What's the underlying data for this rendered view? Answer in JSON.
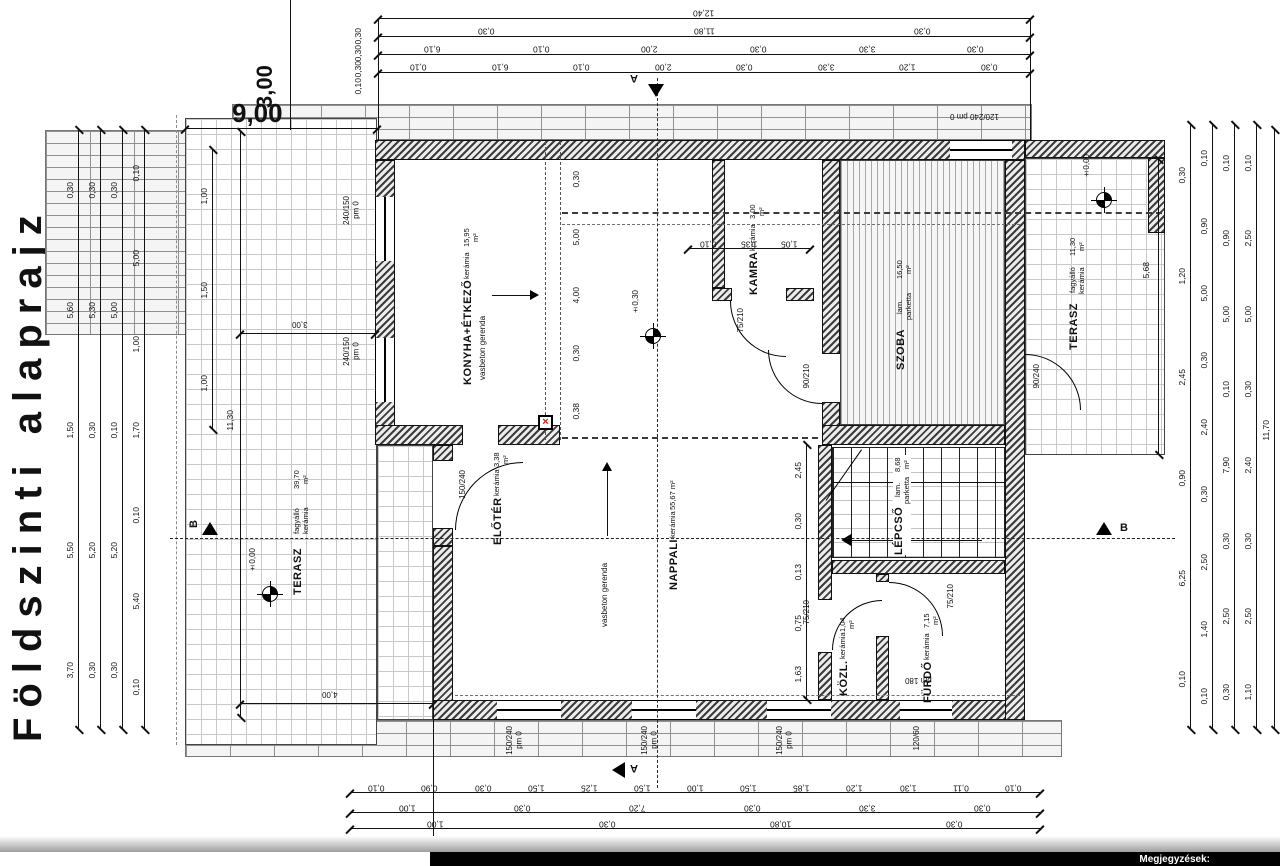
{
  "title": "Földszinti alaprajz",
  "footer": {
    "note_label": "Megjegyzések:"
  },
  "markers": {
    "section_a": "A",
    "section_b": "B",
    "level_terrace": "±0,00",
    "level_interior": "±0,30",
    "level_terrace_right": "±0,00",
    "column_x": "×"
  },
  "beam_label": "vasbeton gerenda",
  "big_dims": {
    "top_width": "9,00",
    "top_offset": "3,00",
    "terrace_width": "3,00",
    "terrace_length": "11,30",
    "terrace_bottom": "4,00",
    "right_terrace_depth": "5,68"
  },
  "rooms": {
    "konyha": {
      "name": "KONYHA+ÉTKEZŐ",
      "floor": "kerámia",
      "area": "15,95 m²"
    },
    "kamra": {
      "name": "KAMRA",
      "floor": "kerámia",
      "area": "3,00 m²"
    },
    "szoba": {
      "name": "SZOBA",
      "floor": "lam. parketta",
      "area": "16,50 m²"
    },
    "nappali": {
      "name": "NAPPALI",
      "floor": "kerámia",
      "area": "55,67 m²"
    },
    "eloter": {
      "name": "ELŐTÉR",
      "floor": "kerámia",
      "area": "3,38 m²"
    },
    "lepcso": {
      "name": "LÉPCSŐ",
      "floor": "lam. parketta",
      "area": "8,68 m²"
    },
    "kozlekedo": {
      "name": "KÖZL.",
      "floor": "kerámia",
      "area": "1,04 m²"
    },
    "furdo": {
      "name": "FÜRDŐ",
      "floor": "kerámia",
      "area": "7,15 m²"
    },
    "terasz_bal": {
      "name": "TERASZ",
      "floor": "fagyálló kerámia",
      "area": "39,70 m²"
    },
    "terasz_jobb": {
      "name": "TERASZ",
      "floor": "fagyálló kerámia",
      "area": "11,30 m²"
    }
  },
  "windows": {
    "konyha_1": {
      "size": "240/150",
      "pm": "pm 0"
    },
    "konyha_2": {
      "size": "240/150",
      "pm": "pm 0"
    },
    "bottom_1": {
      "size": "150/240",
      "pm": "pm 0"
    },
    "bottom_2": {
      "size": "150/240",
      "pm": "pm 0"
    },
    "bottom_3": {
      "size": "150/240",
      "pm": "pm 0"
    },
    "furdo_w": {
      "size": "120/60",
      "pm": "pm 180"
    },
    "top_w": {
      "size": "120/240",
      "pm": "pm 0"
    }
  },
  "doors": {
    "bejarat": {
      "size": "150/240"
    },
    "kamra_d": {
      "size": "75/210"
    },
    "szoba_bal": {
      "size": "90/210"
    },
    "szoba_terasz": {
      "size": "90/240"
    },
    "kozl_d": {
      "size": "75/210"
    },
    "furdo_d": {
      "size": "75/210"
    }
  },
  "chains": {
    "top_1": [
      "12,40"
    ],
    "top_2": [
      "0,30",
      "11,80",
      "0,30"
    ],
    "top_3": [
      "6,10",
      "0,10",
      "2,00",
      "0,30",
      "3,30",
      "0,30"
    ],
    "top_4": [
      "0,10",
      "6,10",
      "0,10",
      "2,00",
      "0,30",
      "3,30",
      "1,20",
      "0,30"
    ],
    "top_corner": [
      "0,30",
      "0,30",
      "0,30",
      "0,10"
    ],
    "bottom_1": [
      "0,10",
      "0,90",
      "0,30",
      "1,50",
      "1,25",
      "1,50",
      "1,00",
      "1,50",
      "1,85",
      "1,20",
      "1,30",
      "0,11",
      "0,10"
    ],
    "bottom_2": [
      "1,00",
      "0,30",
      "7,20",
      "0,30",
      "3,30",
      "0,30"
    ],
    "bottom_3": [
      "1,00",
      "0,30",
      "10,80",
      "0,30"
    ],
    "bottom_4": [
      "1,00",
      "11,40"
    ],
    "left_1": [
      "0,30",
      "5,60",
      "1,50",
      "5,50",
      "3,70"
    ],
    "left_2": [
      "0,30",
      "5,30",
      "0,30",
      "5,20",
      "0,30"
    ],
    "left_3": [
      "0,30",
      "5,00",
      "0,10",
      "5,20",
      "0,30"
    ],
    "left_4": [
      "0,10",
      "5,00",
      "1,00",
      "1,70",
      "0,10",
      "5,40",
      "0,10"
    ],
    "left_inner": [
      "1,00",
      "1,50",
      "1,00"
    ],
    "right_1": [
      "0,30",
      "1,20",
      "2,45",
      "0,90",
      "6,25",
      "0,10"
    ],
    "right_2": [
      "0,10",
      "0,90",
      "5,00",
      "0,30",
      "2,40",
      "0,30",
      "2,50",
      "1,40",
      "0,10"
    ],
    "right_3": [
      "0,10",
      "0,90",
      "5,00",
      "0,10",
      "7,90",
      "0,30",
      "2,50",
      "0,30"
    ],
    "right_4": [
      "0,10",
      "2,50",
      "5,00",
      "0,30",
      "2,40",
      "0,30",
      "2,50",
      "1,10"
    ],
    "right_5": [
      "11,70"
    ],
    "konyha_right": [
      "0,30",
      "5,00",
      "4,00",
      "0,30",
      "0,38"
    ],
    "nappali_right": [
      "2,45",
      "0,30",
      "0,13",
      "0,75",
      "1,63"
    ],
    "kamra_row": [
      "0,10",
      "1,35",
      "1,05"
    ]
  }
}
